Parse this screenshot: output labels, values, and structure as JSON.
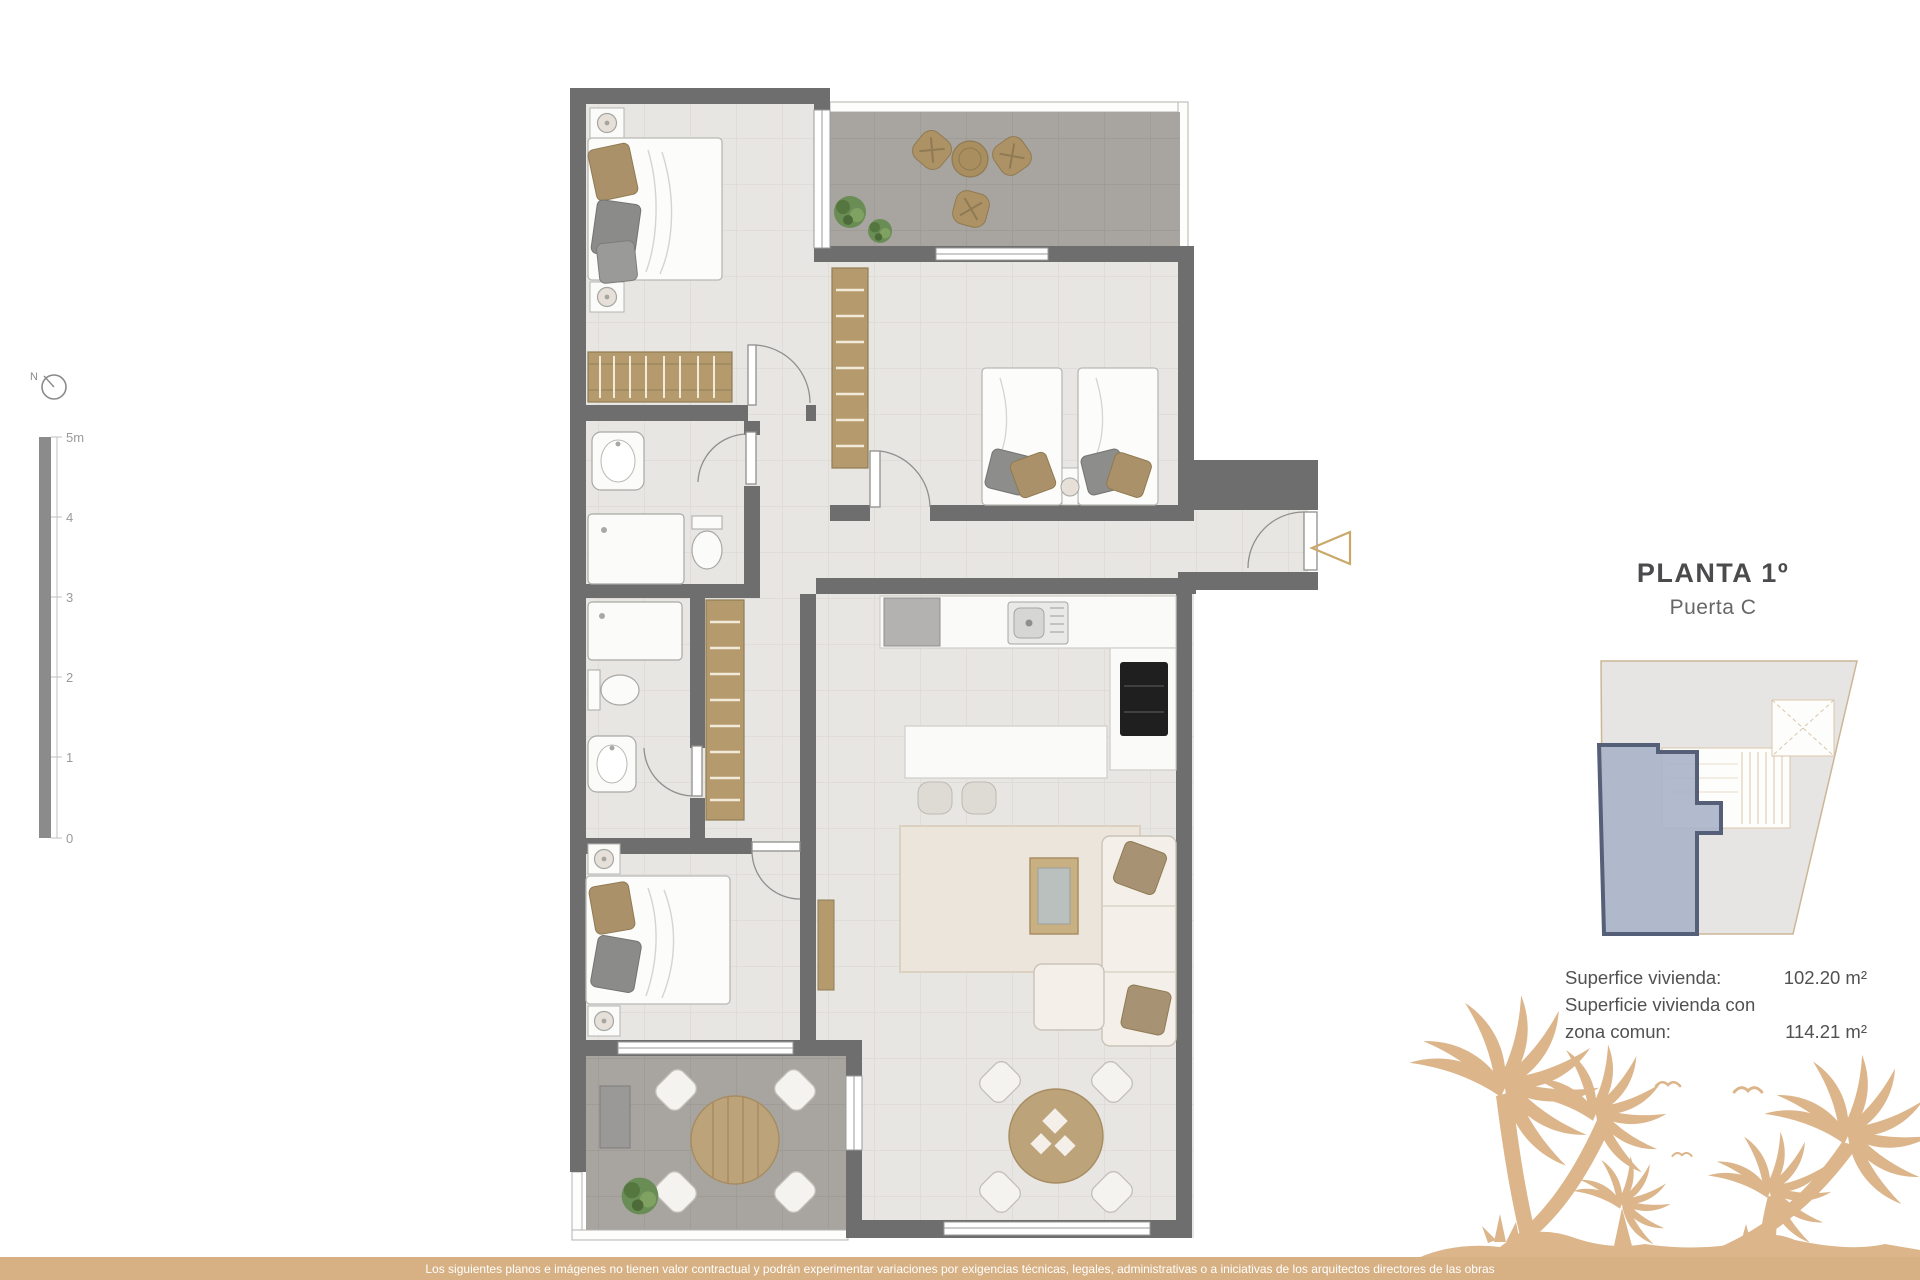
{
  "title_block": {
    "title": "PLANTA 1º",
    "subtitle": "Puerta C"
  },
  "areas": {
    "line1_label": "Superfice vivienda:",
    "line1_value": "102.20 m²",
    "line2_label": "Superficie vivienda con",
    "line3_label": "zona comun:",
    "line3_value": "114.21 m²"
  },
  "scale_bar": {
    "ticks": [
      "5m",
      "4",
      "3",
      "2",
      "1",
      "0"
    ]
  },
  "compass": {
    "label": "N"
  },
  "footer": {
    "disclaimer": "Los siguientes planos e imágenes no tienen valor contractual y podrán experimentar variaciones por exigencias técnicas, legales, administrativas o a iniciativas de los arquitectos directores de las obras"
  },
  "colors": {
    "wall": "#6f6e6e",
    "floor": "#e8e6e3",
    "terrace_floor": "#a8a5a0",
    "wood": "#b49a6d",
    "accent_tan": "#d7b083",
    "palm": "#dcb58a",
    "unit_fill": "#aab3c9",
    "unit_outline": "#565f78",
    "title_text": "#4b4b4d",
    "footer_text": "#ffffff"
  }
}
